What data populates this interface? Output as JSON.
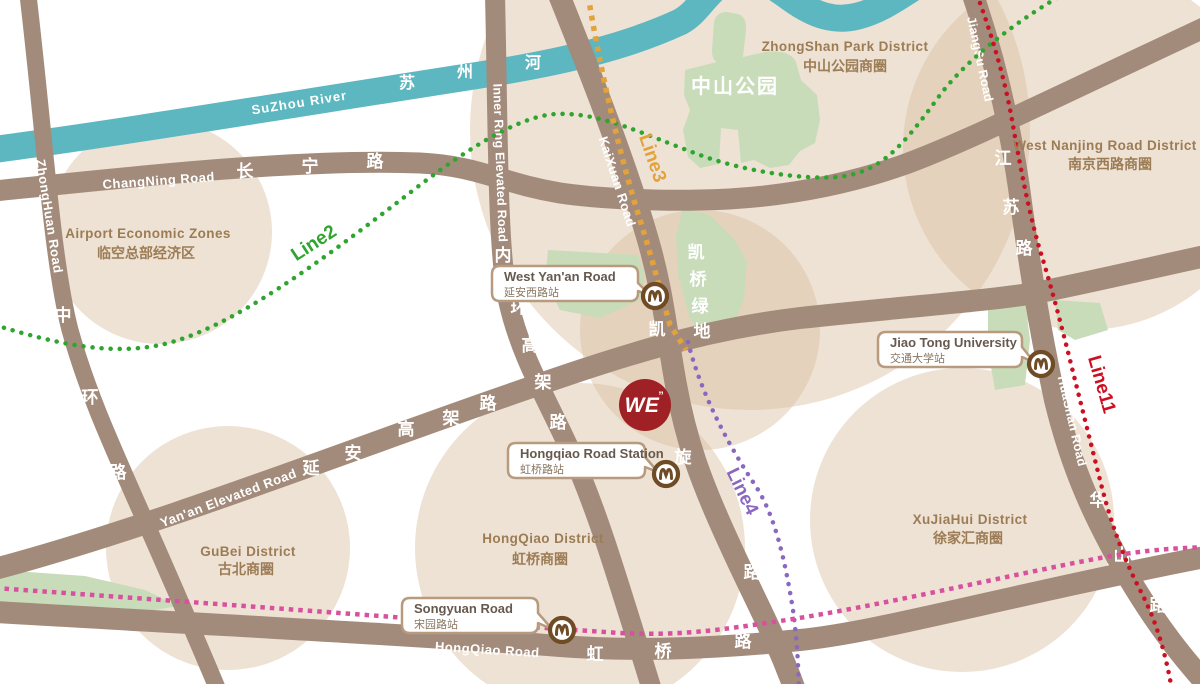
{
  "colors": {
    "background": "#ffffff",
    "district_circle": "#d9bf9f",
    "park_green": "#c9dcba",
    "river": "#5db7c0",
    "road": "#a38b7b",
    "road_text": "#ffffff",
    "district_text": "#9c7c55",
    "line2": "#2ea52e",
    "line3": "#e2a23c",
    "line4": "#8a68c0",
    "line11": "#cc1021",
    "pink_line": "#d8519e",
    "metro_icon": "#6f4b26",
    "callout_border": "#b89a7e",
    "logo_red": "#a02125"
  },
  "river": {
    "en": "SuZhou River",
    "zh_chars": [
      "苏",
      "州",
      "河"
    ]
  },
  "roads": [
    {
      "id": "zhonghuan",
      "en": "ZhongHuan Road",
      "zh_chars": [
        "中",
        "环",
        "路"
      ]
    },
    {
      "id": "changning",
      "en": "ChangNing Road",
      "zh_chars": [
        "长",
        "宁",
        "路"
      ]
    },
    {
      "id": "inner-ring",
      "en": "Inner Ring Elevated Road",
      "zh_chars": [
        "内",
        "环",
        "高",
        "架",
        "路"
      ]
    },
    {
      "id": "kaixuan",
      "en": "KaiXuan Road",
      "zh_chars": [
        "凯",
        "旋",
        "路"
      ]
    },
    {
      "id": "yanan",
      "en": "Yan'an Elevated Road",
      "zh_chars": [
        "延",
        "安",
        "高",
        "架",
        "路"
      ]
    },
    {
      "id": "jiangsu",
      "en": "JiangSu Road",
      "zh_chars": [
        "江",
        "苏",
        "路"
      ]
    },
    {
      "id": "huashan",
      "en": "HuaShan Road",
      "zh_chars": [
        "华",
        "山",
        "路"
      ]
    },
    {
      "id": "hongqiao",
      "en": "HongQiao Road",
      "zh_chars": [
        "虹",
        "桥",
        "路"
      ]
    }
  ],
  "metro_lines": [
    {
      "id": "line2",
      "label": "Line2"
    },
    {
      "id": "line3",
      "label": "Line3"
    },
    {
      "id": "line4",
      "label": "Line4"
    },
    {
      "id": "line11",
      "label": "Line11"
    }
  ],
  "districts": [
    {
      "en": "Airport Economic Zones",
      "zh": "临空总部经济区"
    },
    {
      "en": "ZhongShan Park District",
      "zh": "中山公园商圈"
    },
    {
      "en": "West Nanjing Road District",
      "zh": "南京西路商圈"
    },
    {
      "en": "GuBei District",
      "zh": "古北商圈"
    },
    {
      "en": "HongQiao District",
      "zh": "虹桥商圈"
    },
    {
      "en": "XuJiaHui District",
      "zh": "徐家汇商圈"
    }
  ],
  "parks": [
    {
      "zh": "中山公园"
    },
    {
      "zh_chars": [
        "凯",
        "桥",
        "绿",
        "地"
      ]
    }
  ],
  "stations": [
    {
      "en": "West Yan'an Road",
      "zh": "延安西路站"
    },
    {
      "en": "Hongqiao Road Station",
      "zh": "虹桥路站"
    },
    {
      "en": "Songyuan Road",
      "zh": "宋园路站"
    },
    {
      "en": "Jiao Tong University",
      "zh": "交通大学站"
    }
  ],
  "logo": {
    "text": "WE",
    "mark": "”"
  }
}
